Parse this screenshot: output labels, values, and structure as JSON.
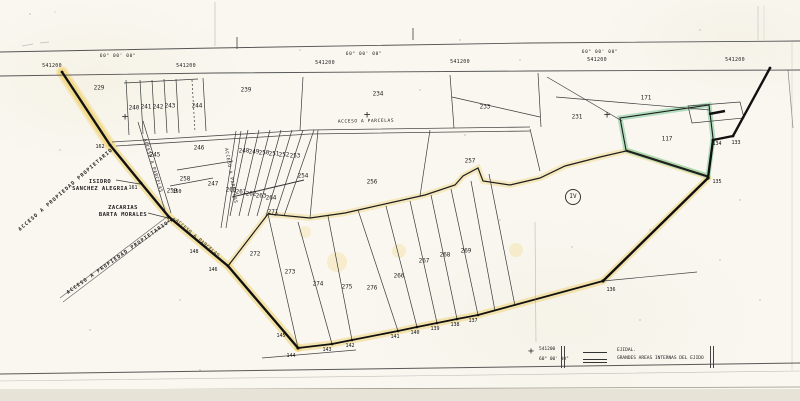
{
  "map": {
    "icons": {
      "grid_cross": "+",
      "zone_circle": "circled-roman-numeral"
    },
    "station_labels": [
      {
        "t": "541200",
        "x": 52,
        "y": 66
      },
      {
        "t": "541200",
        "x": 186,
        "y": 66
      },
      {
        "t": "541200",
        "x": 325,
        "y": 63
      },
      {
        "t": "541200",
        "x": 460,
        "y": 62
      },
      {
        "t": "541200",
        "x": 597,
        "y": 60
      },
      {
        "t": "541200",
        "x": 735,
        "y": 60
      }
    ],
    "bearing_labels": [
      {
        "t": "60° 00' 00\"",
        "x": 118,
        "y": 57
      },
      {
        "t": "60° 00' 00\"",
        "x": 364,
        "y": 55
      },
      {
        "t": "60° 00' 00\"",
        "x": 600,
        "y": 53
      }
    ],
    "parcel_labels": [
      {
        "t": "229",
        "x": 99,
        "y": 88
      },
      {
        "t": "240",
        "x": 134,
        "y": 108
      },
      {
        "t": "241",
        "x": 146,
        "y": 107
      },
      {
        "t": "242",
        "x": 158,
        "y": 107
      },
      {
        "t": "243",
        "x": 170,
        "y": 106
      },
      {
        "t": "244",
        "x": 197,
        "y": 106
      },
      {
        "t": "239",
        "x": 246,
        "y": 90
      },
      {
        "t": "234",
        "x": 378,
        "y": 94
      },
      {
        "t": "233",
        "x": 485,
        "y": 107
      },
      {
        "t": "231",
        "x": 577,
        "y": 117
      },
      {
        "t": "171",
        "x": 646,
        "y": 98
      },
      {
        "t": "117",
        "x": 667,
        "y": 139
      },
      {
        "t": "245",
        "x": 155,
        "y": 155
      },
      {
        "t": "246",
        "x": 199,
        "y": 148
      },
      {
        "t": "258",
        "x": 185,
        "y": 179
      },
      {
        "t": "259",
        "x": 172,
        "y": 191
      },
      {
        "t": "247",
        "x": 213,
        "y": 184
      },
      {
        "t": "248",
        "x": 244,
        "y": 151
      },
      {
        "t": "249",
        "x": 254,
        "y": 152
      },
      {
        "t": "250",
        "x": 264,
        "y": 153
      },
      {
        "t": "251",
        "x": 274,
        "y": 154
      },
      {
        "t": "252",
        "x": 284,
        "y": 155
      },
      {
        "t": "253",
        "x": 295,
        "y": 156
      },
      {
        "t": "254",
        "x": 303,
        "y": 176
      },
      {
        "t": "256",
        "x": 372,
        "y": 182
      },
      {
        "t": "257",
        "x": 470,
        "y": 161
      },
      {
        "t": "260",
        "x": 231,
        "y": 190
      },
      {
        "t": "261",
        "x": 241,
        "y": 192
      },
      {
        "t": "262",
        "x": 251,
        "y": 194
      },
      {
        "t": "263",
        "x": 261,
        "y": 196
      },
      {
        "t": "264",
        "x": 271,
        "y": 198
      },
      {
        "t": "271",
        "x": 273,
        "y": 212
      },
      {
        "t": "272",
        "x": 255,
        "y": 254
      },
      {
        "t": "273",
        "x": 290,
        "y": 272
      },
      {
        "t": "274",
        "x": 318,
        "y": 284
      },
      {
        "t": "275",
        "x": 347,
        "y": 287
      },
      {
        "t": "276",
        "x": 372,
        "y": 288
      },
      {
        "t": "266",
        "x": 399,
        "y": 276
      },
      {
        "t": "267",
        "x": 424,
        "y": 261
      },
      {
        "t": "268",
        "x": 445,
        "y": 255
      },
      {
        "t": "269",
        "x": 466,
        "y": 251
      }
    ],
    "vertex_labels": [
      {
        "t": "162",
        "x": 100,
        "y": 147
      },
      {
        "t": "161",
        "x": 133,
        "y": 188
      },
      {
        "t": "150",
        "x": 177,
        "y": 192
      },
      {
        "t": "149",
        "x": 171,
        "y": 221
      },
      {
        "t": "148",
        "x": 194,
        "y": 252
      },
      {
        "t": "146",
        "x": 213,
        "y": 270
      },
      {
        "t": "145",
        "x": 281,
        "y": 336
      },
      {
        "t": "144",
        "x": 291,
        "y": 356
      },
      {
        "t": "143",
        "x": 327,
        "y": 350
      },
      {
        "t": "142",
        "x": 350,
        "y": 346
      },
      {
        "t": "141",
        "x": 395,
        "y": 337
      },
      {
        "t": "140",
        "x": 415,
        "y": 333
      },
      {
        "t": "139",
        "x": 435,
        "y": 329
      },
      {
        "t": "138",
        "x": 455,
        "y": 325
      },
      {
        "t": "137",
        "x": 473,
        "y": 321
      },
      {
        "t": "136",
        "x": 611,
        "y": 290
      },
      {
        "t": "135",
        "x": 717,
        "y": 182
      },
      {
        "t": "134",
        "x": 717,
        "y": 144
      },
      {
        "t": "133",
        "x": 736,
        "y": 143
      }
    ],
    "road_labels": [
      {
        "t": "ACCESO A PARCELAS",
        "x": 366,
        "y": 122,
        "r": -1
      },
      {
        "t": "ACCESO A PARCELAS",
        "x": 152,
        "y": 166,
        "r": 73
      },
      {
        "t": "ACCESO A PARCELAS",
        "x": 230,
        "y": 176,
        "r": 80
      },
      {
        "t": "ACCESO A PARCELAS",
        "x": 197,
        "y": 239,
        "r": 40
      }
    ],
    "owner_labels": [
      {
        "t": "ISIDRO\nSANCHEZ ALEGRIA",
        "x": 100,
        "y": 186
      },
      {
        "t": "ZACARIAS\nBARTA MORALES",
        "x": 123,
        "y": 212
      }
    ],
    "access_labels": [
      {
        "t": "ACCESO A PROPIEDAD PROPIETARIO",
        "x": 66,
        "y": 190,
        "r": -41
      },
      {
        "t": "ACCESO A PROPIEDAD PROPIETARIO",
        "x": 118,
        "y": 258,
        "r": -35
      }
    ],
    "grid_crosses": [
      {
        "x": 125,
        "y": 117
      },
      {
        "x": 367,
        "y": 115
      },
      {
        "x": 607,
        "y": 115
      }
    ],
    "zone_label": {
      "t": "IV",
      "x": 573,
      "y": 197
    },
    "highlight_colors": {
      "boundary_marker_yellow": "#eecd5f",
      "parcel_marker_green": "#78c796"
    },
    "legend": {
      "station": "541200",
      "bearing": "60° 00' 00\"",
      "items": [
        {
          "symbol": "single-line",
          "label": "EJIDAL."
        },
        {
          "symbol": "double-line",
          "label": "GRANDES AREAS INTERNAS DEL EJIDO"
        }
      ]
    }
  }
}
